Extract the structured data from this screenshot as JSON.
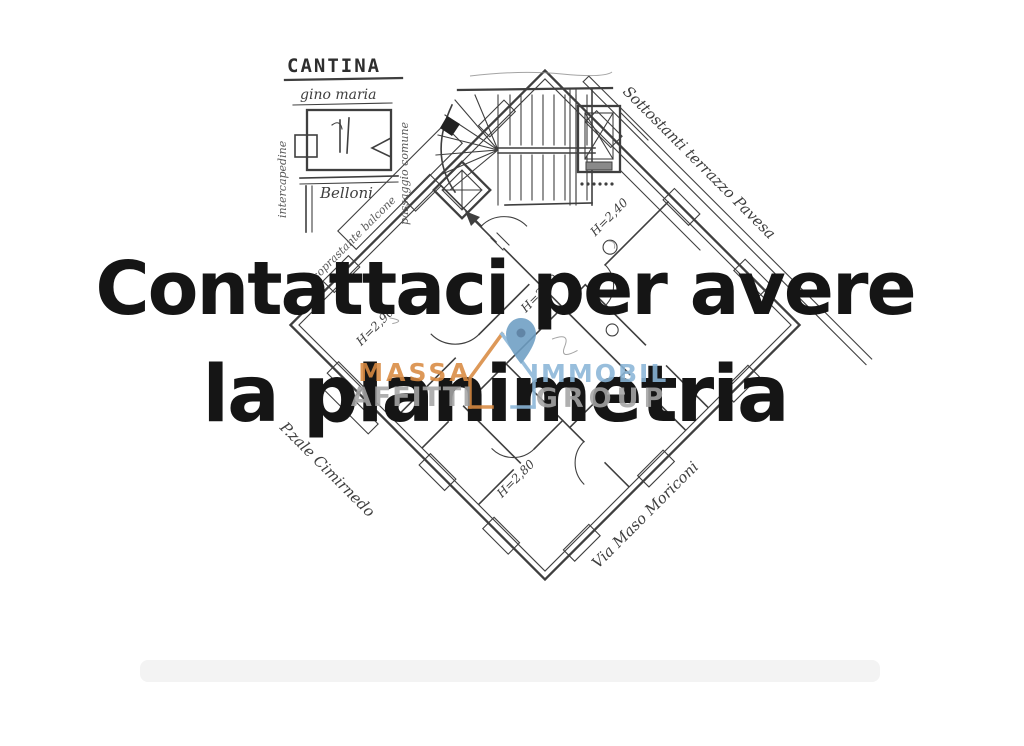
{
  "watermark": {
    "line1": "Contattaci per avere",
    "line2": "la planimetria",
    "text_color": "#151515"
  },
  "logo": {
    "brand_top_left": "MASSA",
    "brand_bottom_left": "AFFITTI",
    "brand_top_right": "IMMOBIL",
    "brand_bottom_right": "GROUP",
    "orange": "#d98a41",
    "light_blue": "#8ab6d8",
    "gray": "#a5a5a5",
    "pin_blue": "#6d9ec3",
    "icon": "house-with-location-pin"
  },
  "floor_plan": {
    "ink_color": "#3f3f3f",
    "cantina": {
      "title": "CANTINA",
      "note": "gino maria",
      "owner": "Belloni",
      "left_label": "intercapedine",
      "right_label": "passaggio comune"
    },
    "annotations": {
      "terrace": "Sottostanti terrazzo Pavesa",
      "street_left": "P.zale Cimirnedo",
      "street_right": "Via Maso Moriconi",
      "balcony": "soprastante balcone"
    },
    "heights": [
      "H=2,90",
      "H=2,80",
      "H=2,40",
      "H=2,80"
    ]
  }
}
